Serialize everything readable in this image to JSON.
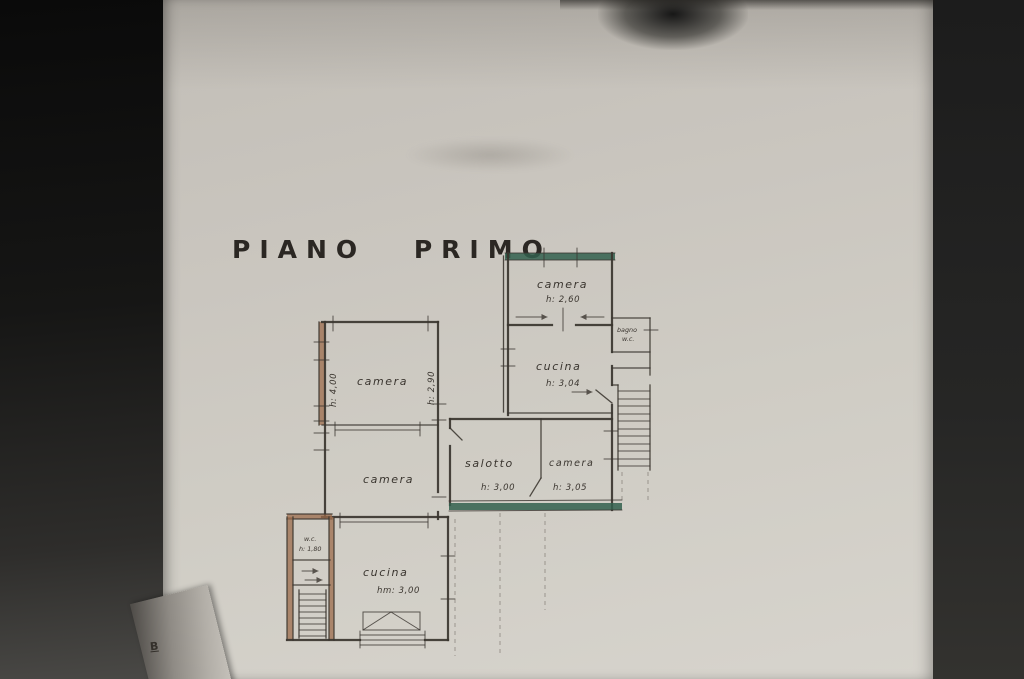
{
  "page": {
    "title": "PIANO PRIMO",
    "margin_mark": "B"
  },
  "rooms": {
    "camera_top": {
      "label": "camera",
      "height": "h: 2,60"
    },
    "bagno": {
      "label": "bagno",
      "sublabel": "w.c."
    },
    "cucina_upper": {
      "label": "cucina",
      "height": "h: 3,04"
    },
    "camera_nw": {
      "label": "camera",
      "height_left": "h: 4,00",
      "height_right": "h: 2,90"
    },
    "camera_w": {
      "label": "camera"
    },
    "salotto": {
      "label": "salotto",
      "height": "h: 3,00"
    },
    "camera_e": {
      "label": "camera",
      "height": "h: 3,05"
    },
    "wc": {
      "label": "w.c.",
      "height": "h: 1,80"
    },
    "cucina_lower": {
      "label": "cucina",
      "height": "hm: 3,00"
    }
  },
  "colors": {
    "paper": "#cfccc4",
    "ink": "#3a352f",
    "highlight_green": "#33604d",
    "wall_brown": "#9c6c4c"
  }
}
